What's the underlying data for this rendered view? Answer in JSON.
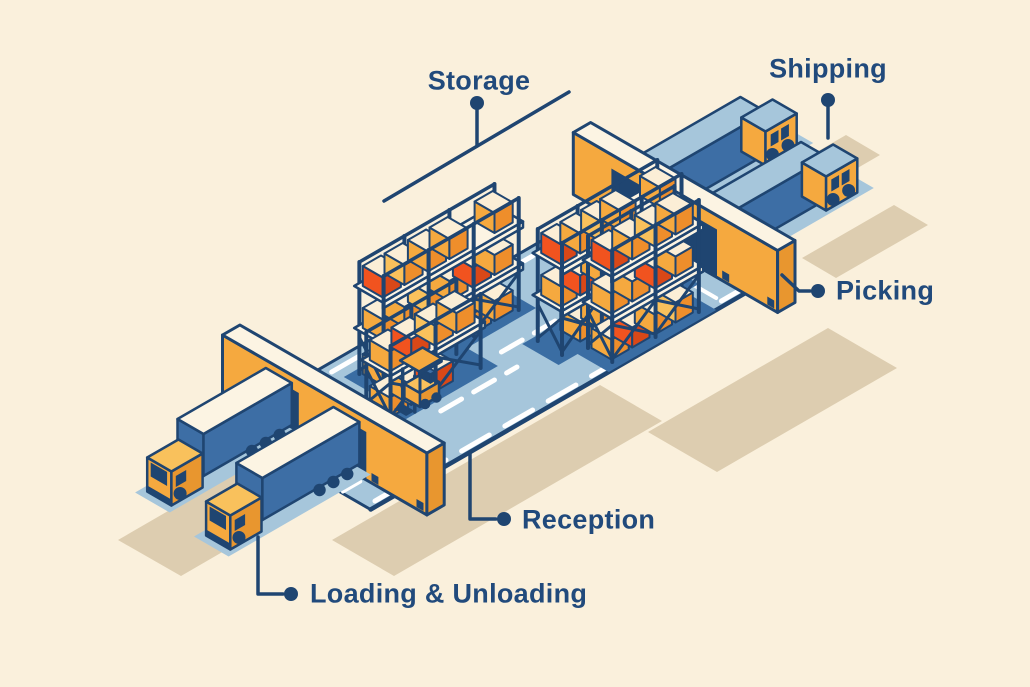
{
  "illustration": {
    "name": "Isometric warehouse process diagram",
    "labels": {
      "storage": "Storage",
      "shipping": "Shipping",
      "picking": "Picking",
      "reception": "Reception",
      "loading_unloading": "Loading & Unloading"
    },
    "palette": {
      "background": "#faf0dc",
      "label_text": "#214a7c",
      "navy": "#1f4571",
      "yellow": "#f5a93f",
      "yellow_light": "#f9c15c",
      "yellow_dark": "#e8962f",
      "orange": "#ee8e2b",
      "red": "#f1531f",
      "red_dark": "#d94818",
      "cream": "#fcf4e3",
      "box_top": "#fbeed6",
      "light_blue": "#a6c6db",
      "mid_blue": "#3d6ea5",
      "aisle_blue": "#3a6da3",
      "tan_shadow": "#ddcdb0",
      "white": "#ffffff"
    }
  }
}
